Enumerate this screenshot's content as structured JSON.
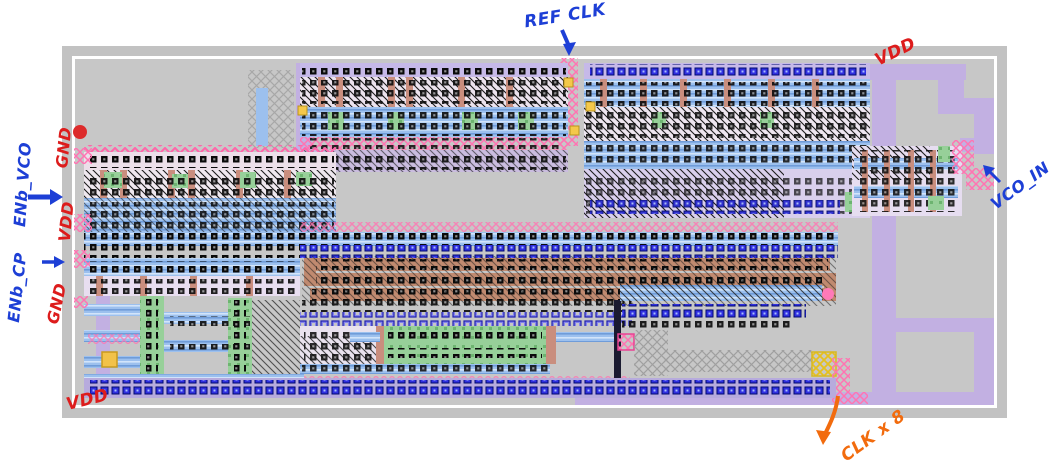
{
  "canvas": {
    "width": 1053,
    "height": 464
  },
  "annotations": {
    "ref_clk": {
      "label": "REF CLK",
      "color": "#1d3fd6"
    },
    "vdd_top_right": {
      "label": "VDD",
      "color": "#dd1c1c"
    },
    "gnd_left_upper": {
      "label": "GND",
      "color": "#dd1c1c"
    },
    "enb_vco": {
      "label": "ENb_VCO",
      "color": "#1d3fd6"
    },
    "vdd_left": {
      "label": "VDD",
      "color": "#dd1c1c"
    },
    "enb_cp": {
      "label": "ENb_CP",
      "color": "#1d3fd6"
    },
    "gnd_left_lower": {
      "label": "GND",
      "color": "#dd1c1c"
    },
    "vco_in": {
      "label": "VCO_IN",
      "color": "#1d3fd6"
    },
    "clk_x8": {
      "label": "CLK x 8",
      "color": "#f26b0d"
    },
    "vdd_bottom_left": {
      "label": "VDD",
      "color": "#dd1c1c"
    }
  },
  "layout_palette": {
    "page_background": "#ffffff",
    "chip_frame_gray": "#c2c2c2",
    "chip_inner_gray": "#c7c7c7",
    "chip_border_line": "#ffffff",
    "metal_blue": "#9cc0ee",
    "via_blue": "#3030e0",
    "route_pink": "#ff74b2",
    "poly_salmon": "#c98e7e",
    "diffusion_green": "#94cf96",
    "power_purple": "#c2b0e2",
    "resistor_brown": "#c08a70",
    "contact_black": "#0a0a0a",
    "marker_yellow": "#f2c24a",
    "marker_red_dot": "#dd2b2b"
  }
}
